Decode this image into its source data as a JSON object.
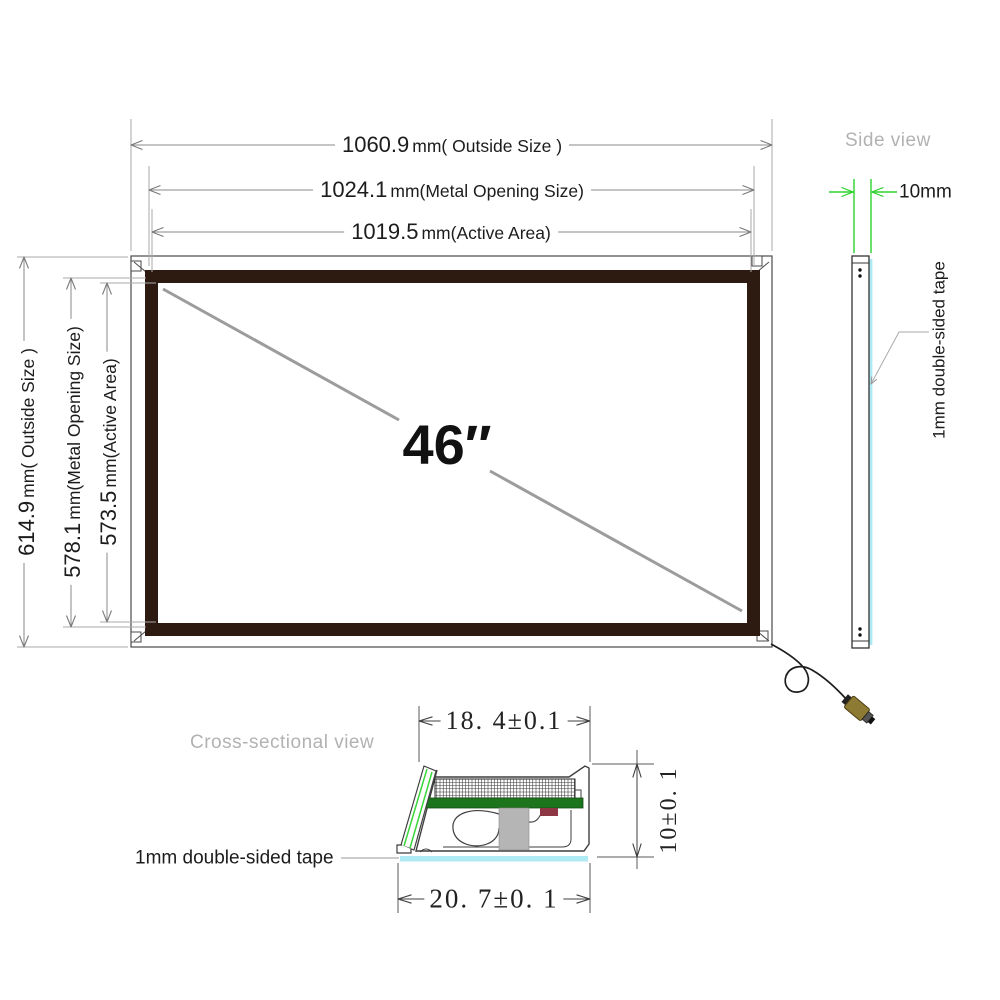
{
  "front_view": {
    "diagonal_size": "46″",
    "top_dims": [
      {
        "value": "1060.9",
        "unit": "mm( Outside Size )"
      },
      {
        "value": "1024.1",
        "unit": "mm(Metal Opening Size)"
      },
      {
        "value": "1019.5",
        "unit": "mm(Active Area)"
      }
    ],
    "left_dims": [
      {
        "value": "614.9",
        "unit": "mm( Outside Size )"
      },
      {
        "value": "578.1",
        "unit": "mm(Metal Opening Size)"
      },
      {
        "value": "573.5",
        "unit": "mm(Active Area)"
      }
    ]
  },
  "side_view": {
    "title": "Side view",
    "thickness": "10mm",
    "tape_label": "1mm double-sided tape"
  },
  "cross_section": {
    "title": "Cross-sectional view",
    "top_width": "18. 4±0.1",
    "bottom_width": "20. 7±0. 1",
    "height": "10±0. 1",
    "tape_label": "1mm double-sided tape"
  },
  "colors": {
    "frame": "#2d1b12",
    "tape": "#aeeaf4",
    "pcb_green": "#1c741c",
    "highlight_green": "#2ed32e",
    "muted_label": "#b2b2b2"
  }
}
